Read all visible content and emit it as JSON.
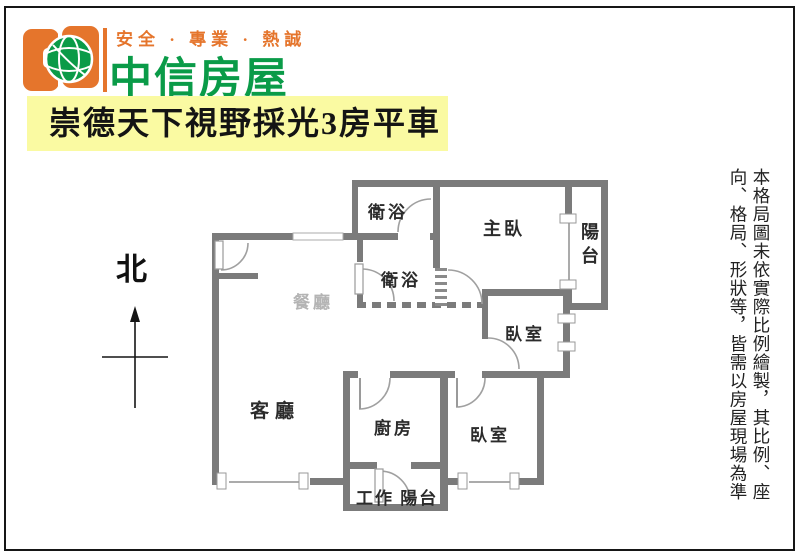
{
  "brand": {
    "slogan": "安全 · 專業 · 熱誠",
    "company_name": "中信房屋",
    "orange": "#e5752c",
    "green": "#0a9b48"
  },
  "title": {
    "text": "崇德天下視野採光3房平車",
    "highlight_color": "#fafaa2"
  },
  "compass": {
    "north_label": "北"
  },
  "plan": {
    "wall_color": "#7b7b7b",
    "rooms": {
      "bath_top": "衛浴",
      "bath_mid": "衛浴",
      "master": "主臥",
      "balcony": "陽台",
      "bedroom_upper": "臥室",
      "dining": "餐廳",
      "living": "客廳",
      "kitchen": "廚房",
      "bedroom_lower": "臥室",
      "work_balcony": "工作 陽台"
    }
  },
  "disclaimer": {
    "column1": "本格局圖未依實際比例繪製，其比例、座",
    "column2": "向、格局、形狀等，皆需以房屋現場為準"
  }
}
